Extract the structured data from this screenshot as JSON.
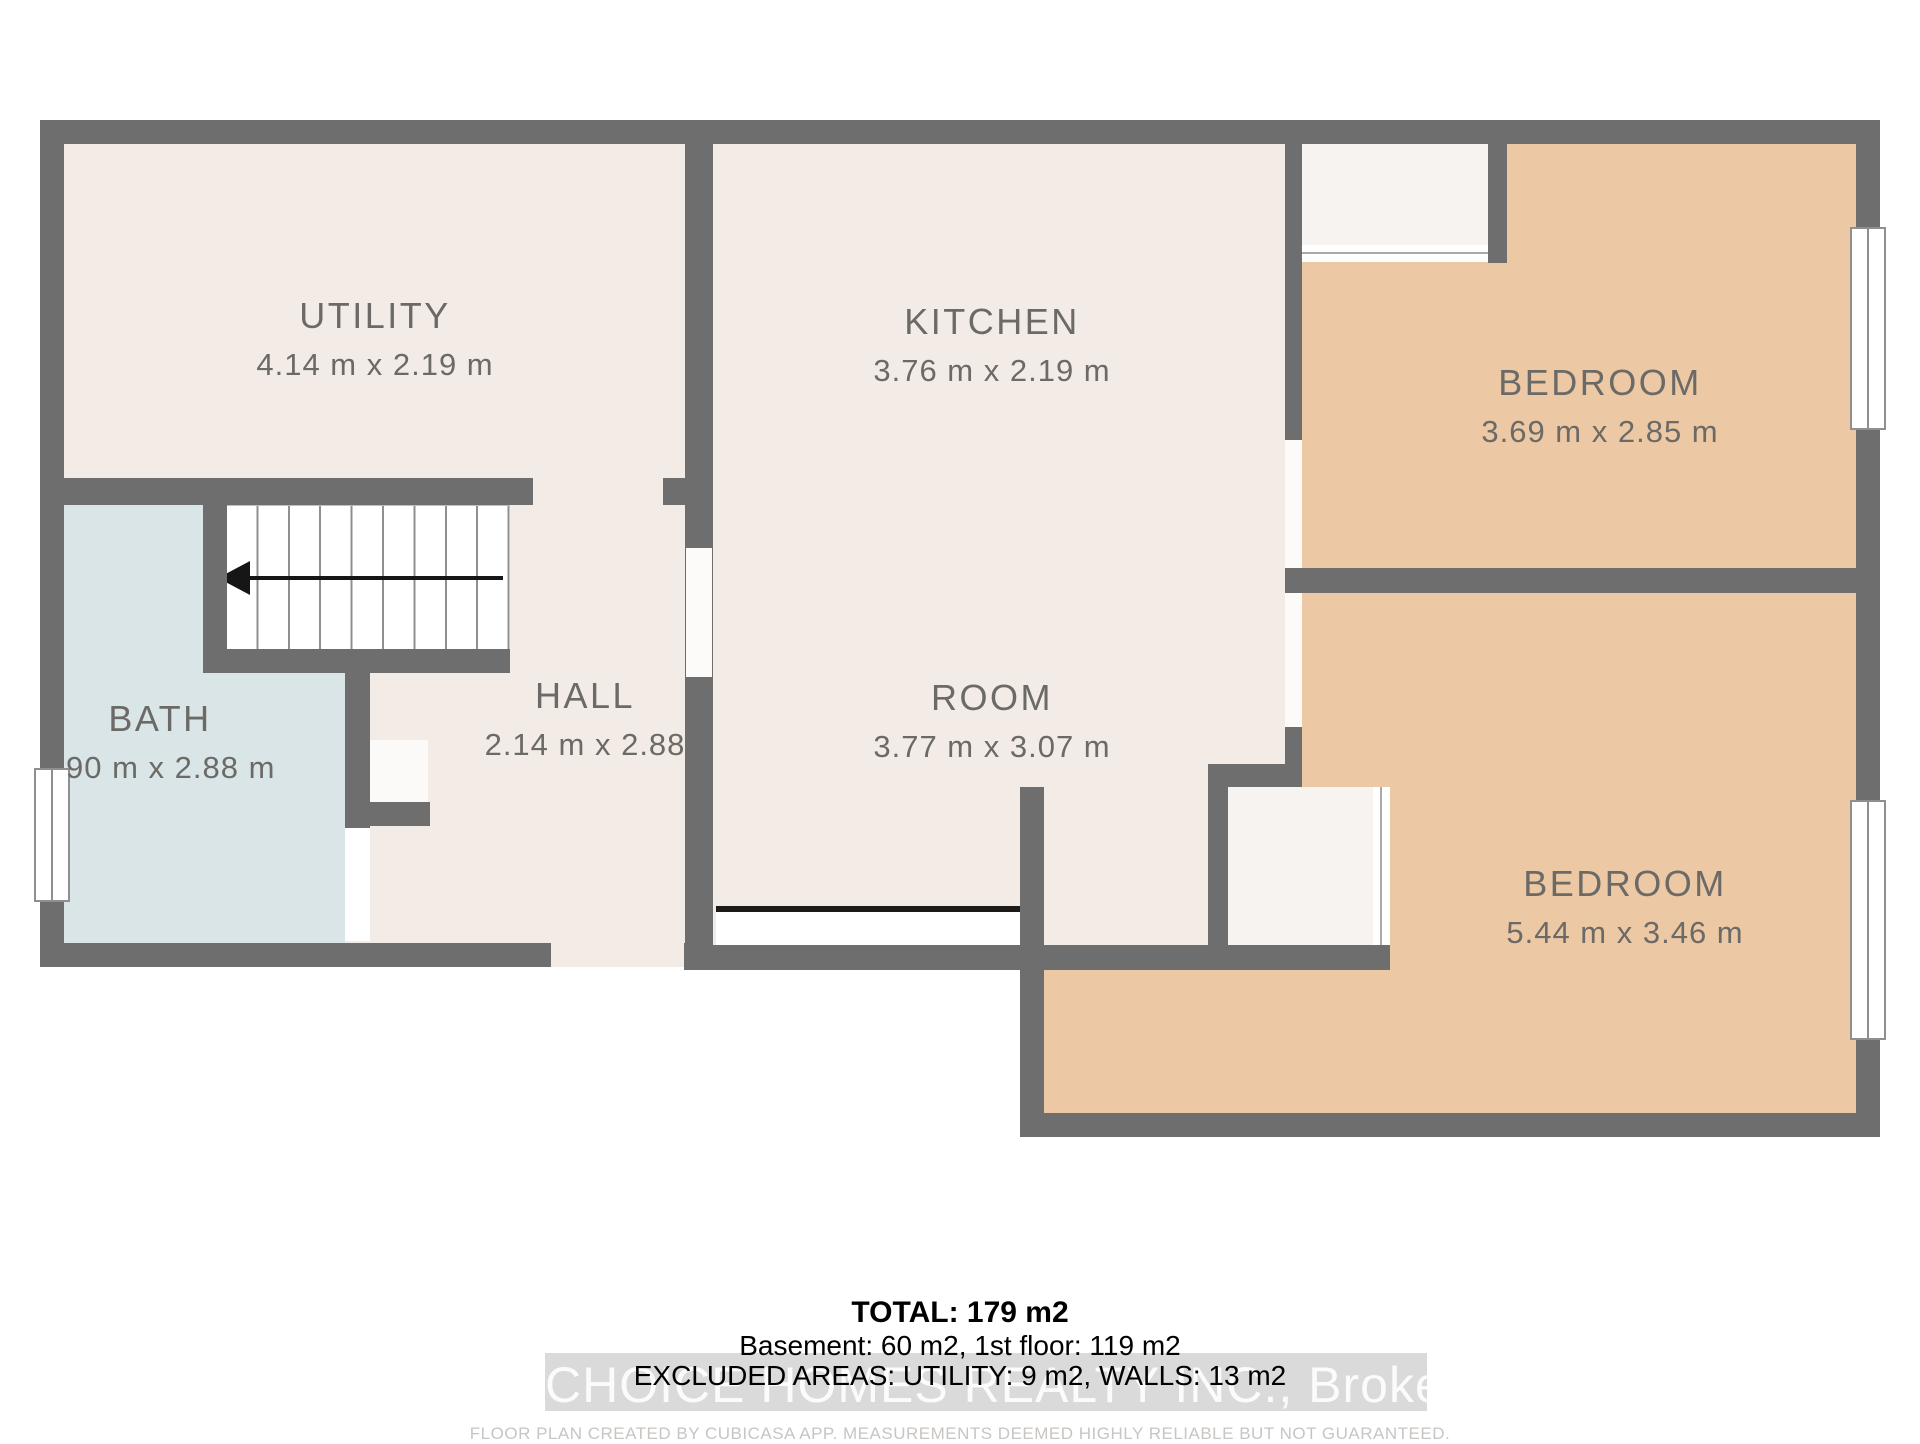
{
  "rooms": {
    "utility": {
      "name": "UTILITY",
      "dims": "4.14 m x 2.19 m"
    },
    "kitchen": {
      "name": "KITCHEN",
      "dims": "3.76 m x 2.19 m"
    },
    "bedroom1": {
      "name": "BEDROOM",
      "dims": "3.69 m x 2.85 m"
    },
    "bath": {
      "name": "BATH",
      "dims": "90 m x 2.88 m"
    },
    "hall": {
      "name": "HALL",
      "dims": "2.14 m x 2.88"
    },
    "room": {
      "name": "ROOM",
      "dims": "3.77 m x 3.07 m"
    },
    "bedroom2": {
      "name": "BEDROOM",
      "dims": "5.44 m x 3.46 m"
    }
  },
  "stairs": {
    "steps": 9,
    "arrow_direction": "left"
  },
  "footer": {
    "total": "TOTAL: 179 m2",
    "areas": "Basement: 60 m2, 1st floor: 119 m2",
    "excluded": "EXCLUDED AREAS: UTILITY: 9 m2, WALLS: 13 m2",
    "watermark": "CHOICE HOMES REALTY INC., Brokerage",
    "disclaimer": "FLOOR PLAN CREATED BY CUBICASA APP. MEASUREMENTS DEEMED HIGHLY RELIABLE BUT NOT GUARANTEED."
  },
  "colors": {
    "wall": "#6e6e6e",
    "floor_cream": "#f3ece6",
    "floor_tan": "#ecc9a4",
    "floor_bath_blue": "#d9e5e6",
    "closet_interior": "#f6f3f0",
    "label_text": "#6c6a66"
  }
}
